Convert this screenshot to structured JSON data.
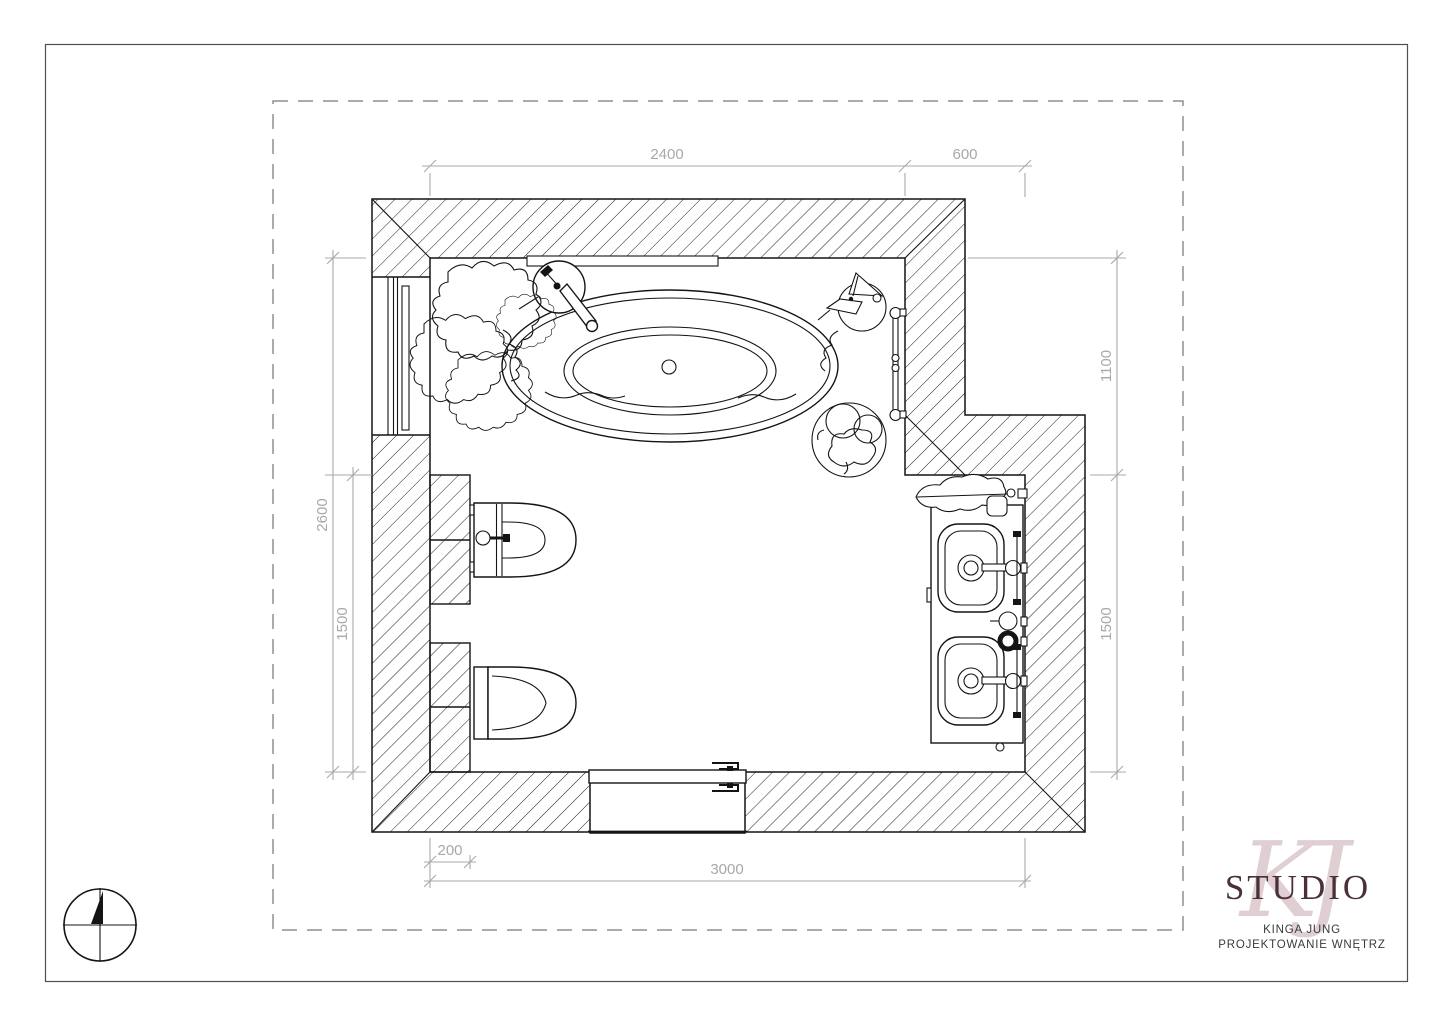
{
  "plan": {
    "title": "bathroom-floor-plan",
    "dimensions": {
      "top": [
        {
          "value": "2400"
        },
        {
          "value": "600"
        }
      ],
      "left": [
        {
          "value": "2600"
        },
        {
          "value": "1500"
        }
      ],
      "right": [
        {
          "value": "1100"
        },
        {
          "value": "1500"
        }
      ],
      "bottom": [
        {
          "value": "200"
        },
        {
          "value": "3000"
        }
      ]
    },
    "fixture_icons": [
      "bathtub-icon",
      "bathtub-faucet-icon",
      "bidet-icon",
      "toilet-icon",
      "double-vanity-icon",
      "sink-icon",
      "towel-radiator-icon",
      "sliding-door-icon",
      "wall-niche-icon",
      "plant-icon",
      "stool-icon",
      "basket-icon",
      "north-compass-icon"
    ],
    "colors": {
      "line": "#141414",
      "dimension": "#a8a8a8",
      "boundary_dash": "#8f8f8f",
      "logo_primary": "#4a3137",
      "logo_script": "#d9c4c7"
    }
  },
  "logo": {
    "monogram": "KJ",
    "studio": "STUDIO",
    "line1": "KINGA JUNG",
    "line2": "PROJEKTOWANIE WNĘTRZ"
  }
}
